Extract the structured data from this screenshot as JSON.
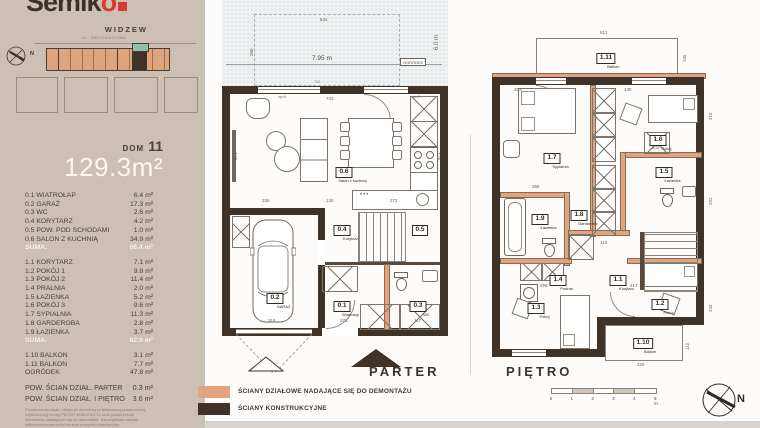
{
  "brand": {
    "name_dark": "Semik",
    "name_accent": "o",
    "subtitle": "WIDZEW"
  },
  "site": {
    "street": "UL. MECHANICZNA"
  },
  "unit": {
    "dom_label": "DOM",
    "dom_number": "11",
    "total_area": "129.3m²"
  },
  "sidebar": {
    "ground": [
      {
        "label": "0.1 WIATROŁAP",
        "area": "6.4 m²"
      },
      {
        "label": "0.2 GARAŻ",
        "area": "17.3 m²"
      },
      {
        "label": "0.3 WC",
        "area": "2.6 m²"
      },
      {
        "label": "0.4 KORYTARZ",
        "area": "4.2 m²"
      },
      {
        "label": "0.5 POW. POD SCHODAMI",
        "area": "1.0 m²"
      },
      {
        "label": "0.6 SALON Z KUCHNIĄ",
        "area": "34.9 m²"
      }
    ],
    "ground_suma": {
      "label": "SUMA:",
      "value": "66.4 m²"
    },
    "floor": [
      {
        "label": "1.1 KORYTARZ",
        "area": "7.1 m²"
      },
      {
        "label": "1.2 POKÓJ 1",
        "area": "9.8 m²"
      },
      {
        "label": "1.3 POKÓJ 2",
        "area": "11.4 m²"
      },
      {
        "label": "1.4 PRALNIA",
        "area": "2.0 m²"
      },
      {
        "label": "1.5 ŁAZIENKA",
        "area": "5.2 m²"
      },
      {
        "label": "1.6 POKÓJ 3",
        "area": "9.6 m²"
      },
      {
        "label": "1.7 SYPIALNIA",
        "area": "11.3 m²"
      },
      {
        "label": "1.8 GARDEROBA",
        "area": "2.8 m²"
      },
      {
        "label": "1.9 ŁAZIENKA",
        "area": "3.7 m²"
      }
    ],
    "floor_suma": {
      "label": "SUMA:",
      "value": "62.9 m²"
    },
    "extras": [
      {
        "label": "1.10  BALKON",
        "area": "3.1 m²"
      },
      {
        "label": "1.11  BALKON",
        "area": "7.7 m²"
      },
      {
        "label": "OGRÓDEK",
        "area": "47.8 m²"
      }
    ],
    "partitions": [
      {
        "label": "POW. ŚCIAN DZIAŁ. PARTER",
        "area": "0.3 m²"
      },
      {
        "label": "POW. ŚCIAN DZIAŁ. I PIĘTRO",
        "area": "3.6 m²"
      }
    ],
    "disclaimer": "Powierzchnia lokalu obejmuje określoną projektowaną powierzchnię użytkową wg normy PN-ISO 9836:2015-12 oraz powierzchnię elementów nadających się do demontażu. Szczegółowe zasady obliczania powierzchni określa prospekt informacyjny."
  },
  "plans": {
    "parter": {
      "label": "PARTER",
      "rooms": [
        {
          "id": "0.6",
          "name": "Salon z kuchnią"
        },
        {
          "id": "0.4",
          "name": "Korytarz"
        },
        {
          "id": "0.5",
          "name": ""
        },
        {
          "id": "0.2",
          "name": "GARAŻ"
        },
        {
          "id": "0.1",
          "name": "Wiatrołap"
        },
        {
          "id": "0.3",
          "name": "WC"
        }
      ],
      "dims": {
        "terrace_w": "544",
        "terrace_h": "200",
        "garden_w": "7.95 m",
        "garden_h": "6.0 m",
        "garden_tag": "OGRÓDEK",
        "gate": "718",
        "top_in": "743",
        "left_v": "471",
        "right_v": "471",
        "b1": "336",
        "b2": "130",
        "b3": "272",
        "garage_w": "316",
        "hall_w": "276",
        "wc_w": "117",
        "win_tag": "hp=0"
      }
    },
    "pietro": {
      "label": "PIĘTRO",
      "rooms": [
        {
          "id": "1.11",
          "name": "Balkon"
        },
        {
          "id": "1.7",
          "name": "Sypialnia"
        },
        {
          "id": "1.6",
          "name": "Pokój"
        },
        {
          "id": "1.9",
          "name": "Łazienka"
        },
        {
          "id": "1.8",
          "name": "Garderoba"
        },
        {
          "id": "1.5",
          "name": "Łazienka"
        },
        {
          "id": "1.4",
          "name": "Pralnia"
        },
        {
          "id": "1.1",
          "name": "Korytarz"
        },
        {
          "id": "1.3",
          "name": "Pokój"
        },
        {
          "id": "1.2",
          "name": "Pokój"
        },
        {
          "id": "1.10",
          "name": "Balkon"
        }
      ],
      "dims": {
        "balcony_w": "512",
        "balcony_h": "145",
        "t1": "303",
        "t2": "430",
        "right_v": "215",
        "m1": "368",
        "m2": "110",
        "m3": "233",
        "right_v2": "232",
        "b1": "256",
        "b2": "417",
        "right_v3": "243",
        "balc2_w": "226",
        "balc2_h": "112",
        "win_tag": "hp=0"
      }
    }
  },
  "legend": {
    "items": [
      {
        "label": "ŚCIANY DZIAŁOWE NADAJĄCE SIĘ DO DEMONTAŻU",
        "color": "#e2a47e"
      },
      {
        "label": "ŚCIANY KONSTRUKCYJNE",
        "color": "#3f3228"
      }
    ]
  },
  "scalebar": {
    "labels": [
      "0",
      "1",
      "2",
      "3",
      "4",
      "5 m"
    ]
  },
  "compass": {
    "label": "N"
  },
  "colors": {
    "sidebar_bg": "#cbc0b3",
    "accent_red": "#da3a30",
    "wall": "#3f3228",
    "partition": "#e2a47e",
    "teal": "#8fc0ad",
    "garden": "#eef2f3",
    "band": "#d9d3cb"
  }
}
